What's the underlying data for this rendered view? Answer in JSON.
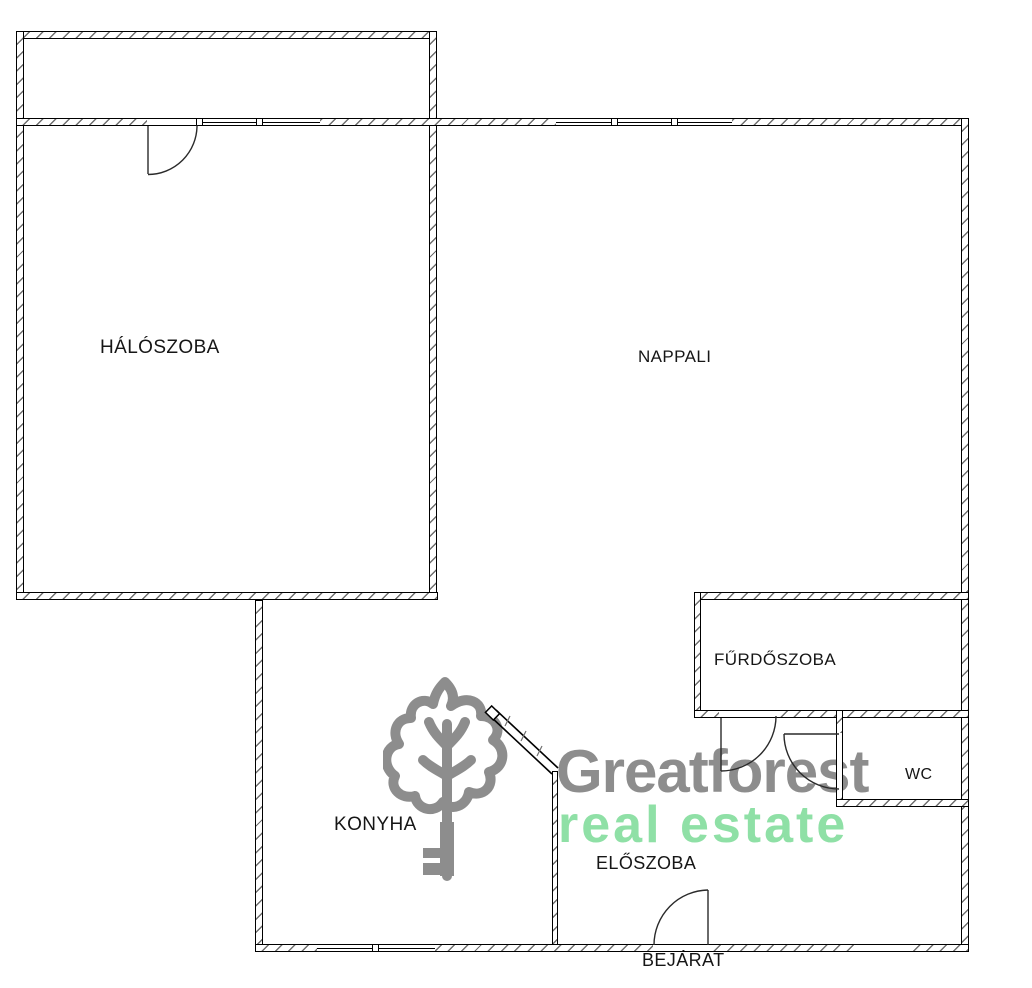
{
  "floorplan": {
    "rooms": {
      "haloszoba": {
        "label": "HÁLÓSZOBA"
      },
      "nappali": {
        "label": "NAPPALI"
      },
      "furdoszoba": {
        "label": "FŰRDŐSZOBA"
      },
      "wc": {
        "label": "WC"
      },
      "konyha": {
        "label": "KONYHA"
      },
      "eloszoba": {
        "label": "ELŐSZOBA"
      }
    },
    "entrance_label": "BEJÁRAT"
  },
  "watermark": {
    "brand": "Greatforest",
    "tagline": "real estate",
    "logo_icon": "oak-tree-key-logo",
    "brand_color": "#8d8d8d",
    "tagline_color": "#8fe0a6"
  },
  "colors": {
    "background": "#ffffff",
    "wall_line": "#000000",
    "wall_hatch": "#6f6f6f",
    "label_text": "#161616"
  }
}
